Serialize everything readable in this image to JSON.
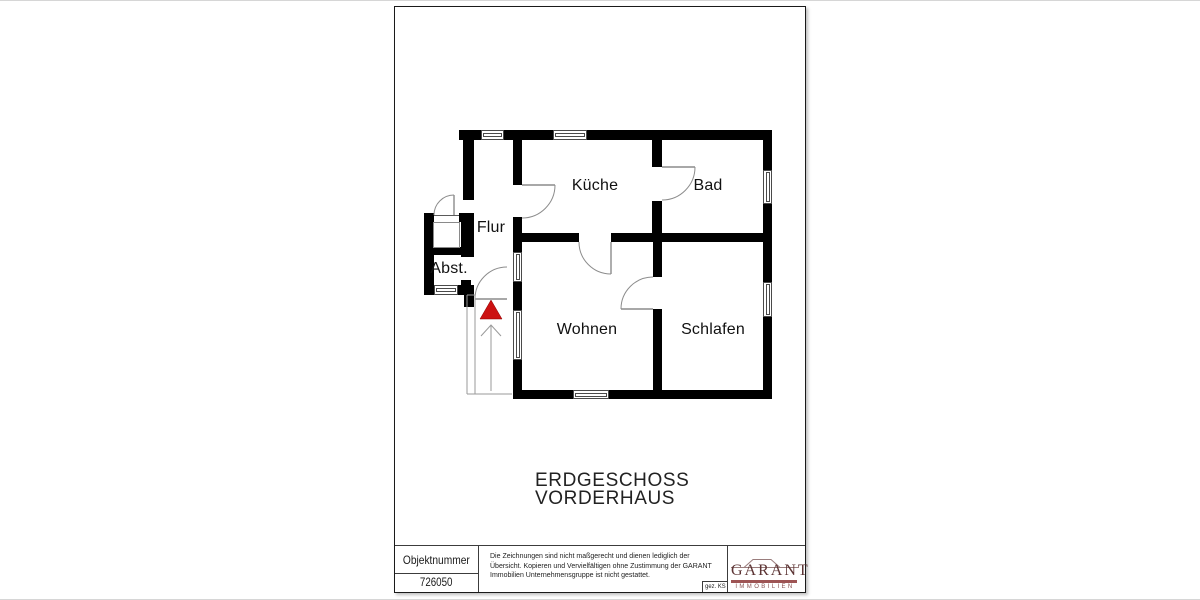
{
  "floor_title": {
    "line1": "ERDGESCHOSS",
    "line2": "VORDERHAUS"
  },
  "title_block": {
    "object_number_label": "Objektnummer",
    "object_number_value": "726050",
    "disclaimer": "Die Zeichnungen sind nicht maßgerecht und dienen lediglich der Übersicht. Kopieren und Vervielfältigen ohne Zustimmung der GARANT Immobilien Unternehmensgruppe ist nicht gestattet.",
    "signed": "gez. KS",
    "logo": {
      "name": "GARANT",
      "sub": "IMMOBILIEN",
      "word_color": "#5c3434",
      "bar_color": "#9e5454"
    }
  },
  "plan": {
    "wall_color": "#000000",
    "line_color": "#8c8c8c",
    "stair_marker_color": "#cc1111",
    "rooms": [
      {
        "id": "kueche",
        "label": "Küche",
        "x": 200,
        "y": 179
      },
      {
        "id": "bad",
        "label": "Bad",
        "x": 313,
        "y": 179
      },
      {
        "id": "flur",
        "label": "Flur",
        "x": 96,
        "y": 221
      },
      {
        "id": "abst",
        "label": "Abst.",
        "x": 54,
        "y": 262
      },
      {
        "id": "wohnen",
        "label": "Wohnen",
        "x": 192,
        "y": 323
      },
      {
        "id": "schlafen",
        "label": "Schlafen",
        "x": 318,
        "y": 323
      }
    ],
    "walls": [
      [
        64,
        123,
        313,
        10
      ],
      [
        368,
        123,
        9,
        269
      ],
      [
        118,
        383,
        259,
        9
      ],
      [
        118,
        123,
        9,
        269
      ],
      [
        68,
        123,
        11,
        70
      ],
      [
        29,
        206,
        10,
        82
      ],
      [
        64,
        206,
        15,
        9
      ],
      [
        66,
        206,
        13,
        44
      ],
      [
        29,
        240,
        42,
        8
      ],
      [
        66,
        273,
        10,
        12
      ],
      [
        29,
        278,
        50,
        10
      ],
      [
        69,
        288,
        10,
        12
      ],
      [
        118,
        226,
        259,
        9
      ],
      [
        257,
        128,
        10,
        100
      ],
      [
        258,
        226,
        9,
        166
      ]
    ],
    "door_openings": [
      [
        118,
        178,
        9,
        32
      ],
      [
        257,
        160,
        10,
        34
      ],
      [
        184,
        226,
        32,
        9
      ],
      [
        258,
        270,
        9,
        32
      ]
    ],
    "windows": [
      {
        "x": 86,
        "y": 123,
        "w": 23,
        "h": 10,
        "o": "h"
      },
      {
        "x": 158,
        "y": 123,
        "w": 34,
        "h": 10,
        "o": "h"
      },
      {
        "x": 368,
        "y": 163,
        "w": 9,
        "h": 34,
        "o": "v"
      },
      {
        "x": 368,
        "y": 275,
        "w": 9,
        "h": 35,
        "o": "v"
      },
      {
        "x": 178,
        "y": 383,
        "w": 36,
        "h": 9,
        "o": "h"
      },
      {
        "x": 118,
        "y": 245,
        "w": 9,
        "h": 30,
        "o": "v"
      },
      {
        "x": 118,
        "y": 303,
        "w": 9,
        "h": 50,
        "o": "v"
      },
      {
        "x": 39,
        "y": 278,
        "w": 24,
        "h": 10,
        "o": "h"
      }
    ],
    "threshold": {
      "x": 39,
      "y": 206,
      "w": 25,
      "h": 9
    },
    "niche": [
      38,
      215,
      27,
      26
    ],
    "doors": [
      {
        "id": "kueche-door",
        "leaf": "M127,178 L160,178",
        "arc": "M160,178 A33,33 0 0 1 127,211"
      },
      {
        "id": "bad-door",
        "leaf": "M267,160 L300,160",
        "arc": "M300,160 A33,33 0 0 1 267,193"
      },
      {
        "id": "wohnen-door",
        "leaf": "M216,235 L216,267",
        "arc": "M184,235 A32,32 0 0 0 216,267"
      },
      {
        "id": "schlafen-door",
        "leaf": "M258,302 L226,302",
        "arc": "M226,302 A32,32 0 0 1 258,270"
      },
      {
        "id": "entrance-door",
        "leaf": "M59,188 L59,208",
        "arc": "M39,208 A20,20 0 0 1 59,188"
      },
      {
        "id": "stairs-door",
        "leaf": "M80,292 L112,292",
        "arc": "M80,292 A32,32 0 0 1 112,260"
      }
    ],
    "stairs": {
      "lines": [
        "M72,288 L72,387",
        "M80,288 L80,387",
        "M72,387 L117,387",
        "M72,288 L80,288",
        "M96,318 L96,384",
        "M86,329 L96,318 L106,329"
      ],
      "triangle_points": "96,293 85,312 107,312"
    }
  }
}
